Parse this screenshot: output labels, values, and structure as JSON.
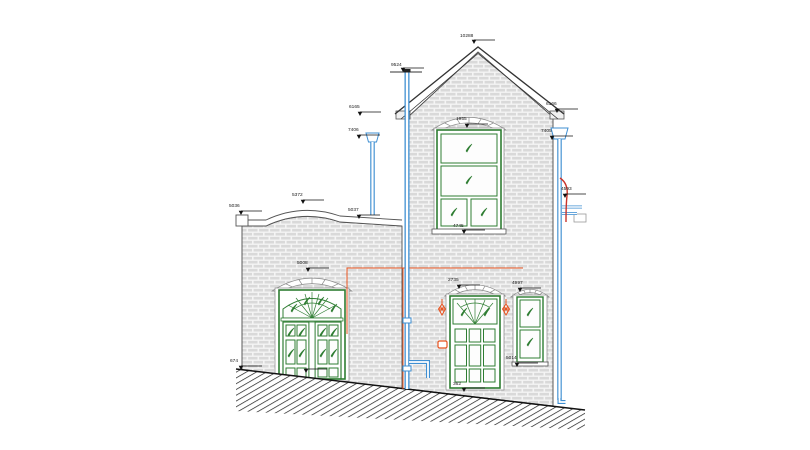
{
  "drawing": {
    "type": "building-front-elevation",
    "colors": {
      "background": "#ffffff",
      "brick": "#d9d9d9",
      "mortar": "#f4f4f4",
      "outline": "#4a4a4a",
      "joinery_green": "#2e7d32",
      "rainwater_blue": "#3f8fd2",
      "services_orange": "#e8531f",
      "flue_red": "#c9342b",
      "dimension_black": "#1a1a1a"
    },
    "dimensions": {
      "ridge": "10288",
      "vent_pipe": "9524",
      "left_eave": "6165",
      "left_rainwater_head": "7406",
      "right_eave": "6166",
      "right_rainwater_head": "7405",
      "parapet_left": "5036",
      "parapet_apex": "5372",
      "parapet_right": "5037",
      "flue": "4593",
      "gable_window_head": "1955",
      "gable_window_sill": "4745",
      "entrance_door_head": "2735",
      "side_window_head": "4997",
      "side_window_sill": "5014",
      "left_door_head": "5008",
      "ground_level_left": "674",
      "entrance_threshold": "362"
    },
    "symbols": {
      "casement_opening": "leaf-icon",
      "wall_light": "lantern-icon",
      "ground": "diagonal-hatch",
      "dimension_marker": "down-arrow-with-leader"
    }
  }
}
